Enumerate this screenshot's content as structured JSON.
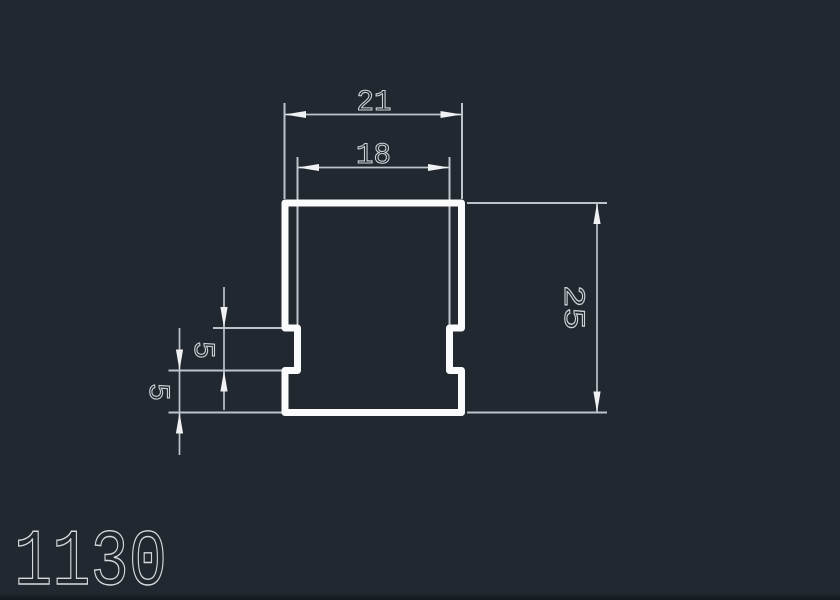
{
  "drawing": {
    "part_number": "1130",
    "dimensions": {
      "outer_width": "21",
      "inner_width": "18",
      "overall_height": "25",
      "notch_height": "5",
      "notch_offset": "5"
    }
  },
  "colors": {
    "background": "#212830",
    "profile_outline": "#fafbfc",
    "dimension_lines": "#bcc3ca",
    "dimension_text": "#ced3d8",
    "part_number_text": "#d6d9dc"
  }
}
